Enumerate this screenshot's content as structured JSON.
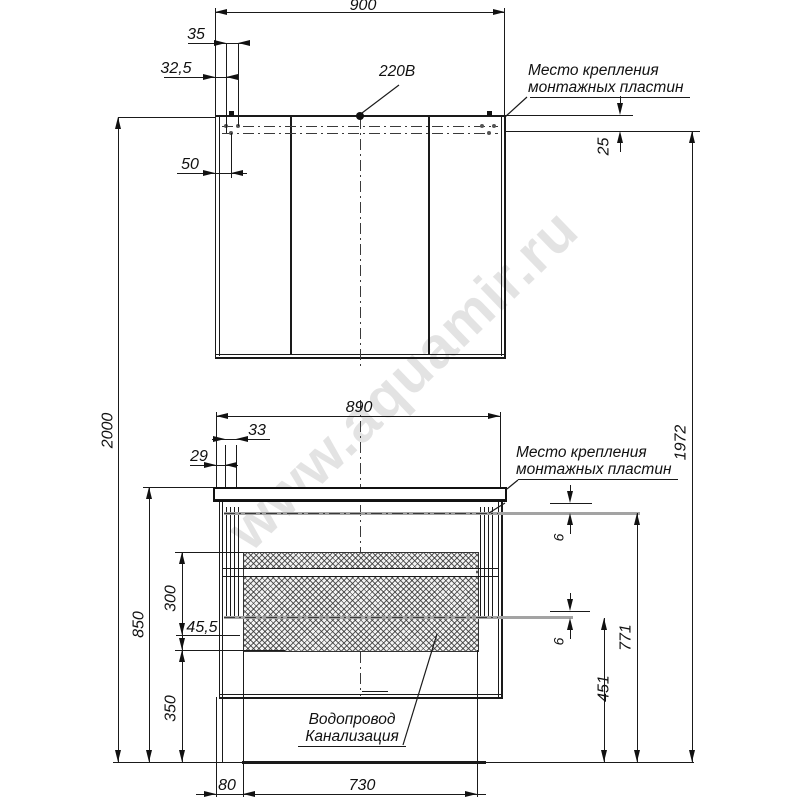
{
  "watermark": "www.aquamir.ru",
  "labels": {
    "power": "220В",
    "mount_plate_line1": "Место крепления",
    "mount_plate_line2": "монтажных пластин",
    "plumbing_line1": "Водопровод",
    "plumbing_line2": "Канализация"
  },
  "dimensions": {
    "mirror_width": "900",
    "d35": "35",
    "d32_5": "32,5",
    "d50": "50",
    "d25": "25",
    "total_height": "2000",
    "mount_height": "1972",
    "vanity_width": "890",
    "d33": "33",
    "d29": "29",
    "d6_top": "6",
    "d6_bottom": "6",
    "vanity_height": "850",
    "d300": "300",
    "d45_5": "45,5",
    "d350": "350",
    "d771": "771",
    "d451": "451",
    "d80": "80",
    "d730": "730"
  }
}
